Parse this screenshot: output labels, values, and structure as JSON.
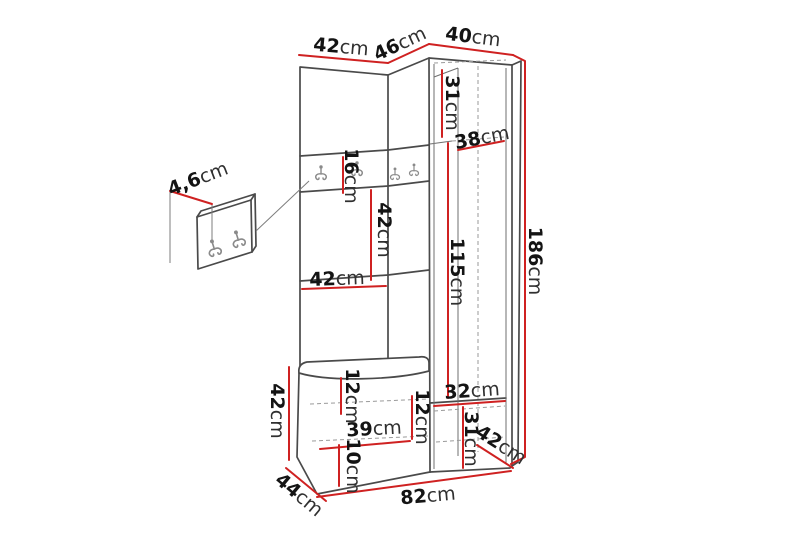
{
  "diagram": {
    "type": "furniture-dimension-diagram",
    "subject": "hallway storage unit with wardrobe, hook rail and bench",
    "unit": "cm",
    "colors": {
      "dimension_line": "#cf2121",
      "outline": "#4a4a4a",
      "detail_line": "#8a8a8a",
      "label_text": "#161616",
      "background": "#ffffff"
    },
    "labels": {
      "top_width": {
        "value": "42",
        "unit": "cm"
      },
      "top_depth": {
        "value": "46",
        "unit": "cm"
      },
      "wardrobe_width": {
        "value": "40",
        "unit": "cm"
      },
      "panel_thickness": {
        "value": "4,6",
        "unit": "cm"
      },
      "hook_rail_height": {
        "value": "16",
        "unit": "cm"
      },
      "upper_shelf_depth": {
        "value": "31",
        "unit": "cm"
      },
      "interior_width": {
        "value": "38",
        "unit": "cm"
      },
      "total_height": {
        "value": "186",
        "unit": "cm"
      },
      "door_height": {
        "value": "115",
        "unit": "cm"
      },
      "niche_height": {
        "value": "42",
        "unit": "cm"
      },
      "niche_width": {
        "value": "42",
        "unit": "cm"
      },
      "bench_height": {
        "value": "42",
        "unit": "cm"
      },
      "seat_thickness": {
        "value": "12",
        "unit": "cm"
      },
      "bench_inner_width": {
        "value": "39",
        "unit": "cm"
      },
      "bench_inner_height": {
        "value": "12",
        "unit": "cm"
      },
      "plinth_height": {
        "value": "10",
        "unit": "cm"
      },
      "lower_shelf_width": {
        "value": "32",
        "unit": "cm"
      },
      "lower_shelf_height": {
        "value": "31",
        "unit": "cm"
      },
      "bottom_depth": {
        "value": "42",
        "unit": "cm"
      },
      "bench_depth": {
        "value": "44",
        "unit": "cm"
      },
      "total_width": {
        "value": "82",
        "unit": "cm"
      }
    }
  }
}
